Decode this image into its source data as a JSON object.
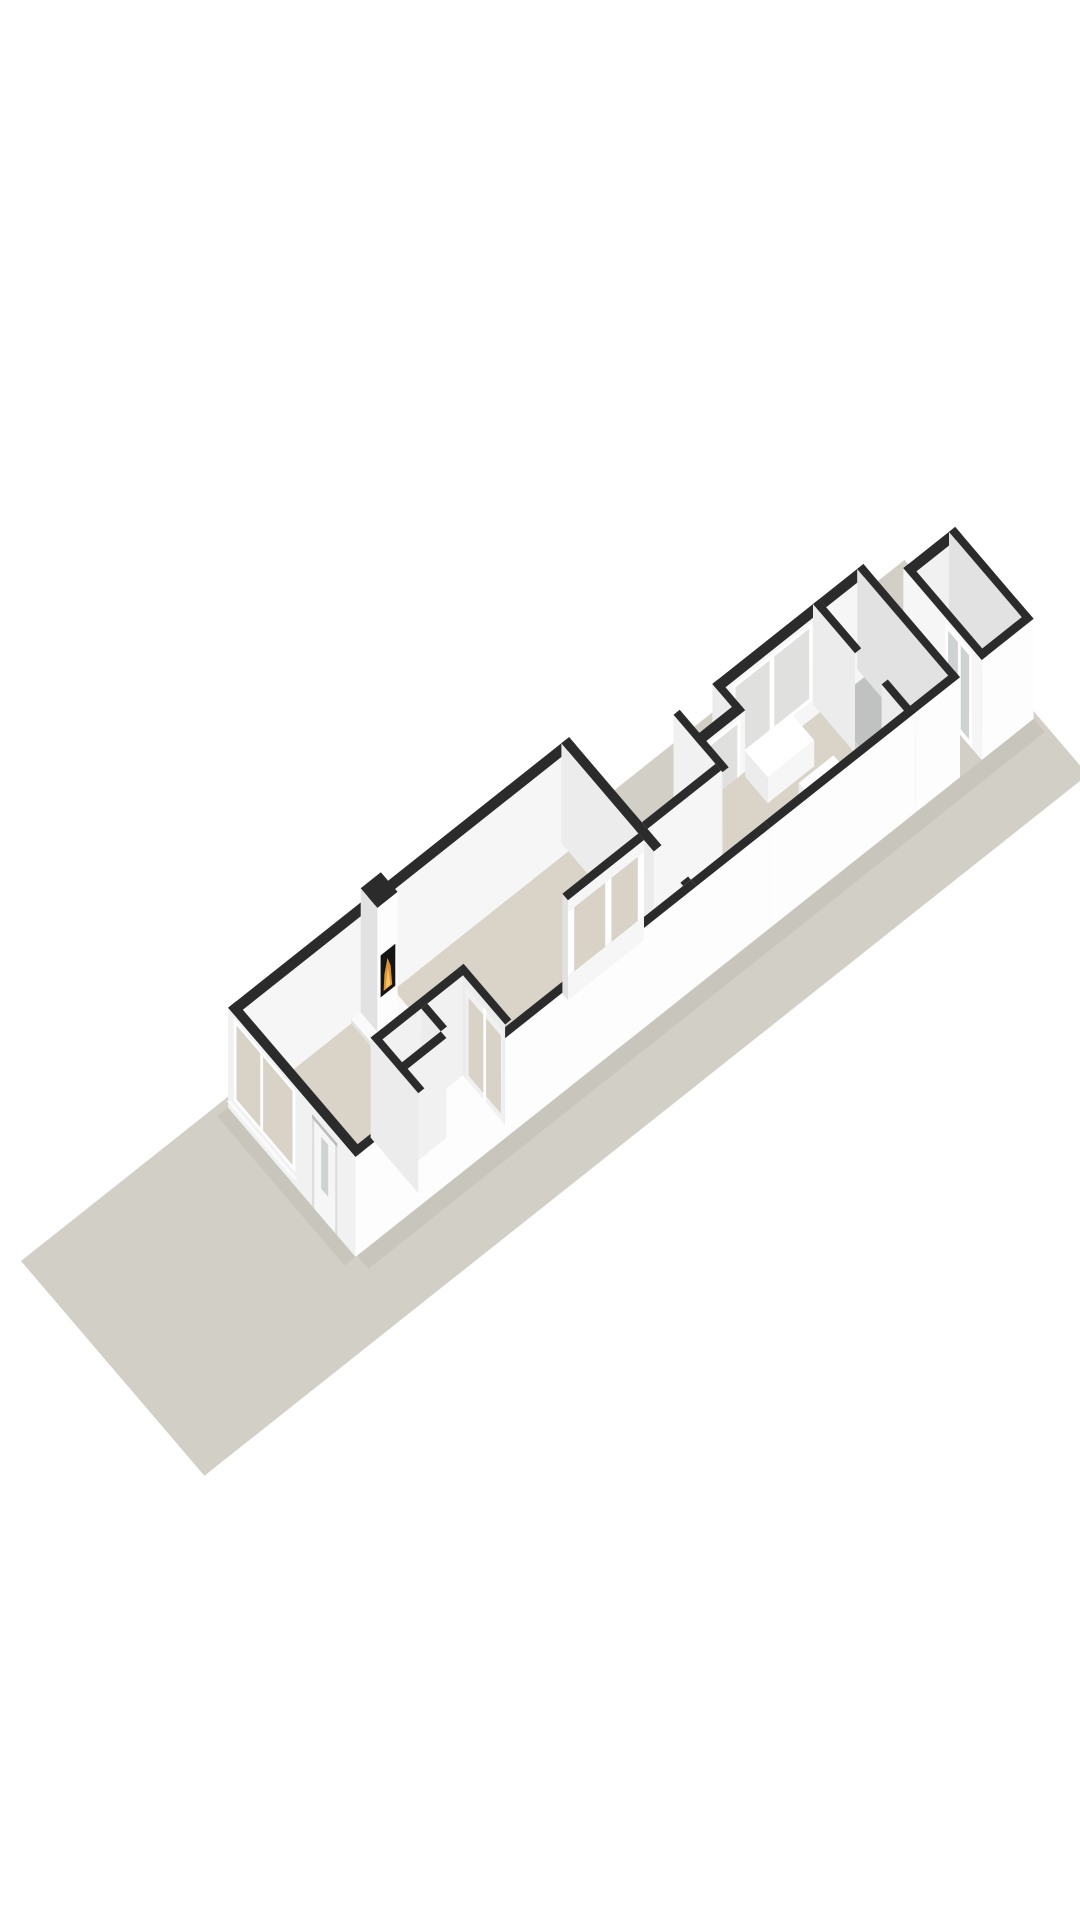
{
  "meta": {
    "kind": "3d-floorplan-render",
    "view": "axonometric",
    "canvas": {
      "width": 1080,
      "height": 1920
    },
    "background": "#ffffff"
  },
  "scene": {
    "ground": {
      "name": "lot-ground-strip",
      "color": "#d1cfc6"
    },
    "palette": {
      "wallTop": "#2b2b2c",
      "wallBright": "#fdfdfd",
      "wallLight": "#f6f6f6",
      "wallSoft": "#f1f1f1",
      "wallShade": "#ececec",
      "wallDim": "#e2e2e2",
      "wallDark": "#d6d6d6",
      "floorBeige": "#dad3c8",
      "floorBeigeDeep": "#d5cdc1",
      "floorGray": "#c0c2c2",
      "floorGrayShed": "#bcbfc0",
      "glassCool": "#e0e1de",
      "glassWarm": "#d8d2c7",
      "glassDoor": "#cfd2d2",
      "frameWhite": "#ffffff",
      "sillWhite": "#fafafa",
      "recessGray": "#dddddd",
      "lintelGray": "#bdbdbd",
      "fireboxBlack": "#151515",
      "flameOrange": "#df9434",
      "flameYellow": "#f5c660",
      "shadow": "rgba(70,68,58,0.07)"
    },
    "elements": [
      {
        "name": "lot-ground-strip",
        "role": "garden plot"
      },
      {
        "name": "main-house",
        "role": "front building volume with living room"
      },
      {
        "name": "living-room",
        "floor": "#dad3c8"
      },
      {
        "name": "fireplace",
        "flame": [
          "#df9434",
          "#f5c660"
        ]
      },
      {
        "name": "entrance-hall-partitions",
        "role": "hall, toilet and closet walls"
      },
      {
        "name": "interior-double-doors",
        "glazing": "#d6d0c6"
      },
      {
        "name": "front-window",
        "glazing": "#d9d3c9"
      },
      {
        "name": "front-door",
        "glazing": "#c9cbcb"
      },
      {
        "name": "rear-passage",
        "floor": "#dad3c8"
      },
      {
        "name": "rear-annex",
        "role": "kitchen / dining extension",
        "floor": "#dad3c8"
      },
      {
        "name": "annex-window-band",
        "glazing": "#e0e1de"
      },
      {
        "name": "kitchen-blocks",
        "color": "#ffffff"
      },
      {
        "name": "utility-room",
        "floor": "#c0c2c2"
      },
      {
        "name": "garden-shed",
        "floor": "#bcbfc0"
      },
      {
        "name": "shed-glazed-door",
        "glazing": "#cfd2d2"
      }
    ]
  }
}
